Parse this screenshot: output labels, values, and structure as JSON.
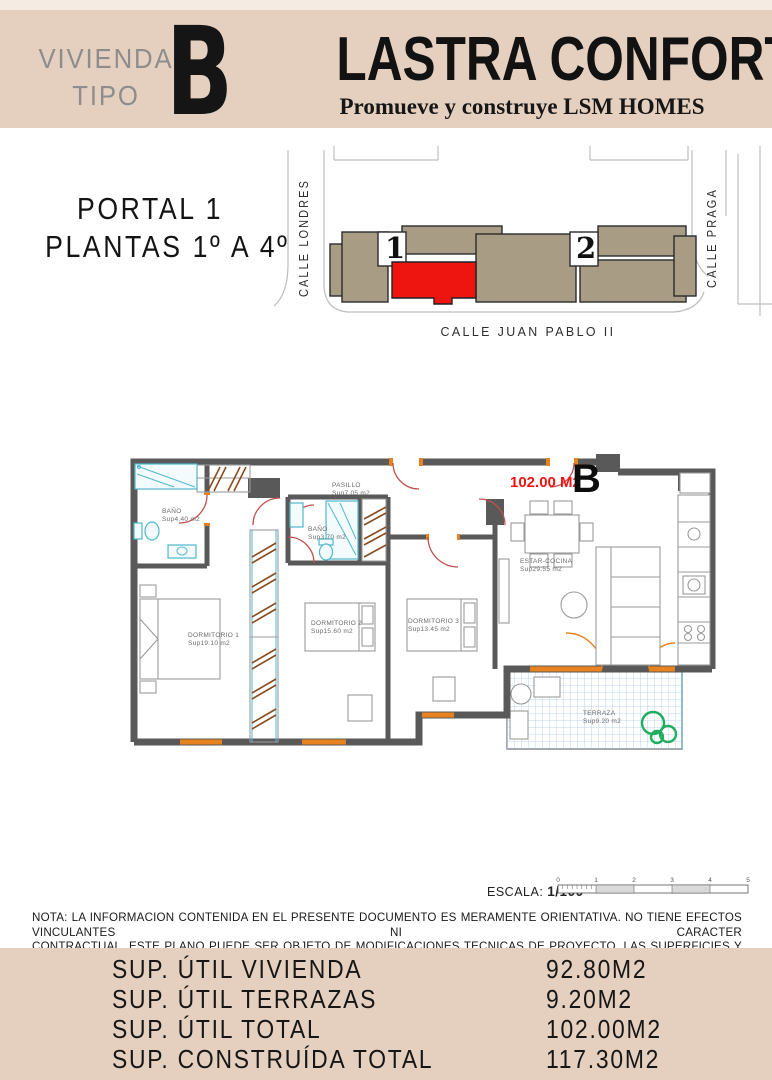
{
  "colors": {
    "beige": "#e5d0bf",
    "beige-light": "#f6ebe2",
    "accent-red": "#ee1511",
    "building-tan": "#a89c84",
    "wall-gray": "#595959",
    "door-orange": "#e8821e",
    "arc-red": "#c0504d",
    "fixture-cyan": "#4fb8cc",
    "terraza-blue": "#a9c9ec",
    "plant-green": "#1fae5e",
    "hatch-brown": "#8a4a1e",
    "text-gray": "#8d8d8d"
  },
  "header": {
    "unit_type_line1": "VIVIENDA",
    "unit_type_line2": "TIPO",
    "unit_letter": "B",
    "title": "LASTRA CONFORT",
    "subtitle": "Promueve y construye LSM HOMES"
  },
  "location": {
    "portal": "PORTAL 1",
    "plantas": "PLANTAS 1º A 4º",
    "street_left": "CALLE LONDRES",
    "street_right": "CALLE PRAGA",
    "street_bottom": "CALLE JUAN PABLO II",
    "portal_1_label": "1",
    "portal_2_label": "2"
  },
  "floor_plan": {
    "total_area_label": "102.00 M2",
    "unit_letter": "B",
    "rooms": [
      {
        "name": "BAÑO",
        "area": "Sup4.40 m2"
      },
      {
        "name": "PASILLO",
        "area": "Sup7.05 m2"
      },
      {
        "name": "BAÑO",
        "area": "Sup3.70 m2"
      },
      {
        "name": "DORMITORIO 1",
        "area": "Sup19.10 m2"
      },
      {
        "name": "DORMITORIO 2",
        "area": "Sup15.60 m2"
      },
      {
        "name": "DORMITORIO 3",
        "area": "Sup13.45 m2"
      },
      {
        "name": "ESTAR-COCINA",
        "area": "Sup29.55 m2"
      },
      {
        "name": "TERRAZA",
        "area": "Sup9.20 m2"
      }
    ]
  },
  "scale": {
    "label": "ESCALA:",
    "value": "1/100",
    "ticks": [
      "0",
      "1",
      "2",
      "3",
      "4",
      "5"
    ]
  },
  "note": {
    "line1": "NOTA: LA INFORMACION CONTENIDA EN EL PRESENTE DOCUMENTO ES MERAMENTE ORIENTATIVA. NO TIENE EFECTOS VINCULANTES NI CARACTER",
    "line2": "CONTRACTUAL. ESTE PLANO PUEDE SER OBJETO DE MODIFICACIONES TECNICAS DE PROYECTO. LAS SUPERFICIES Y COTAS SON APROXIMADAS."
  },
  "summary": {
    "rows": [
      {
        "label": "SUP. ÚTIL VIVIENDA",
        "value": "92.80M2"
      },
      {
        "label": "SUP. ÚTIL TERRAZAS",
        "value": "9.20M2"
      },
      {
        "label": "SUP. ÚTIL TOTAL",
        "value": "102.00M2"
      },
      {
        "label": "SUP. CONSTRUÍDA TOTAL",
        "value": "117.30M2"
      }
    ]
  }
}
